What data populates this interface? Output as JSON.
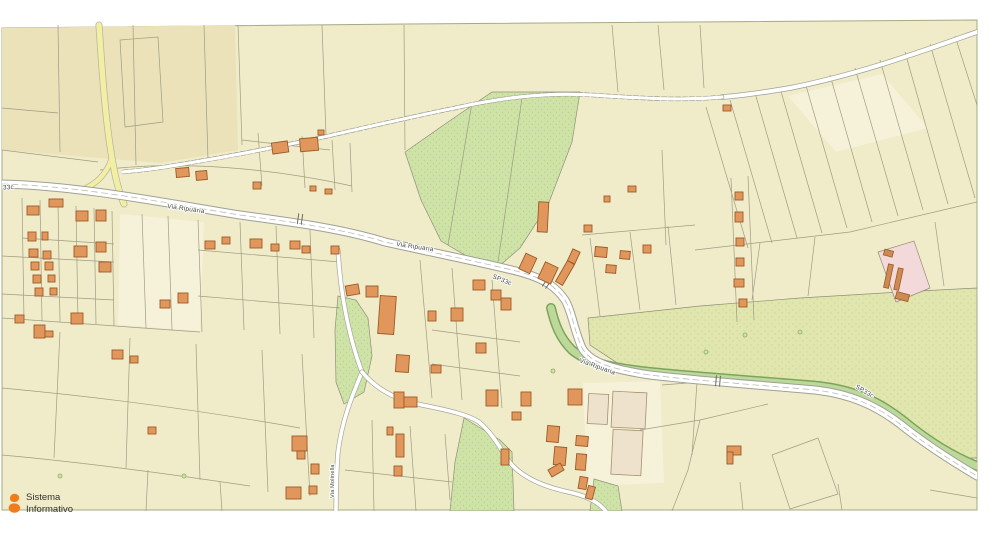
{
  "map": {
    "type": "cadastral-gis-map",
    "road_labels": [
      {
        "text": "SP33c"
      },
      {
        "text": "Via Ripuaria"
      },
      {
        "text": "Via Ripuaria"
      },
      {
        "text": "SP33c"
      },
      {
        "text": "Via Ripuaria"
      },
      {
        "text": "SP33c"
      },
      {
        "text": "Via Molinella"
      }
    ],
    "watermark": {
      "line1": "Sistema",
      "line2": "Informativo"
    },
    "colors": {
      "parcel_base": "#f0ebc8",
      "parcel_dark": "#ebe2ba",
      "parcel_light": "#f6f1d9",
      "field_green": "#cfe3a9",
      "field_olive": "#e0e6ae",
      "canal_green": "#bcd99a",
      "canal_edge": "#7da45c",
      "building_fill": "#e1975c",
      "building_stroke": "#9c5a28",
      "building_pale": "#efe2cd",
      "road_fill": "#ffffff",
      "road_casing": "#a0a096",
      "road_yellow": "#f2efa2",
      "boundary": "#8f9078",
      "pink": "#f4d9da",
      "logo_orange": "#ef7d1d"
    }
  }
}
